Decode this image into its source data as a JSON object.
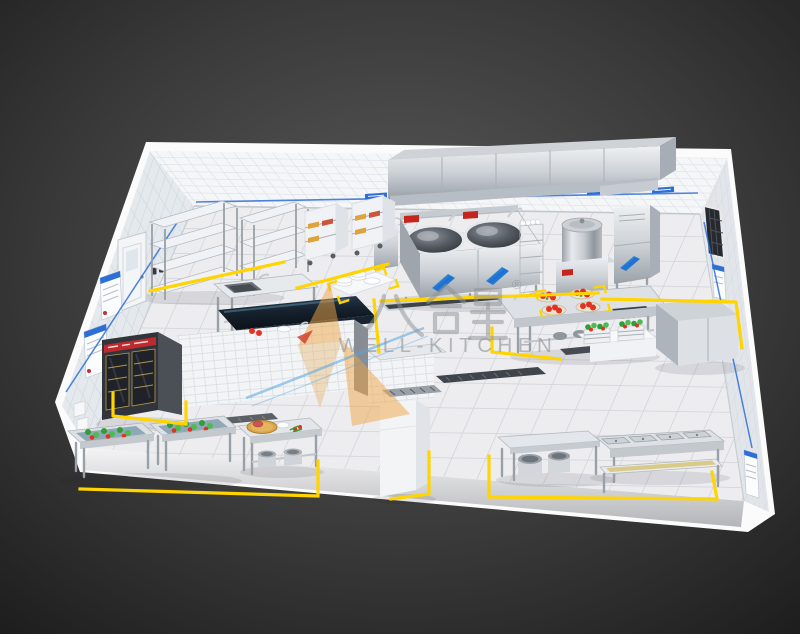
{
  "scene": {
    "title": "Commercial kitchen 3D floor plan render",
    "view": "isometric cutaway",
    "room": "white tiled walls, marble tile floor, stainless steel equipment"
  },
  "watermark": {
    "brand_cn": "八合星",
    "registered_mark": "®",
    "brand_en": "WELL-KITCHEN"
  },
  "palette": {
    "accent_yellow": "#ffd400",
    "accent_blue": "#2e6fd6",
    "accent_red": "#c4251d",
    "veg_green": "#2e9e35",
    "tomato_red": "#e23222",
    "wood": "#d8a64c",
    "watermark_gray": "#8e9094",
    "steel_light": "#eff1f3",
    "steel_dark": "#9aa1a8",
    "wall_tile": "#f5f6f8",
    "floor_tile": "#ededf0",
    "background_dark": "#1d1d1d"
  },
  "equipment_inventory": [
    "exhaust-hood",
    "double-wok-range",
    "hand-wash-sink",
    "condiment-rack",
    "soup-kettle",
    "steam-cabinet",
    "storage-shelving-rack-1",
    "storage-shelving-rack-2",
    "tray-trolley-1",
    "tray-trolley-2",
    "prep-table-with-sink",
    "plate-stack-counter",
    "dark-top-pass-counter",
    "tiled-partition-counter",
    "tomato-tray-counter",
    "vegetable-crates",
    "stainless-work-cabinet",
    "two-door-display-fridge",
    "vegetable-wash-sink-1",
    "vegetable-wash-sink-2",
    "cutting-board-prep-table",
    "upright-white-cabinet",
    "pot-shelf-table",
    "four-well-sink-line",
    "low-pot-rack",
    "floor-drain-channels"
  ],
  "wall_signage": {
    "back_wall_equipment_tags": 5,
    "left_wall_posters": 2,
    "right_wall_posters": 2,
    "right_wall_vent_window": 1,
    "left_wall_door": 1
  }
}
